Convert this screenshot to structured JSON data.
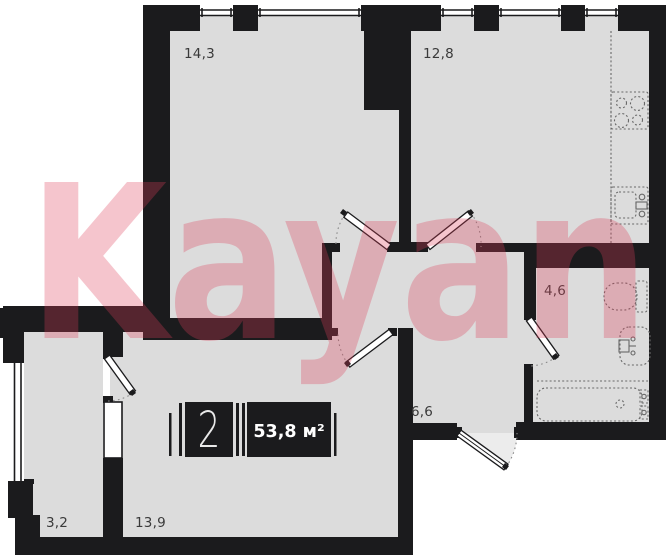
{
  "plan": {
    "badge": {
      "rooms_count": "2",
      "total_area": "53,8 м²"
    },
    "rooms": [
      {
        "name": "living-room",
        "label": "14,3"
      },
      {
        "name": "kitchen",
        "label": "12,8"
      },
      {
        "name": "bathroom",
        "label": "4,6"
      },
      {
        "name": "hallway",
        "label": "6,6"
      },
      {
        "name": "balcony",
        "label": "3,2"
      },
      {
        "name": "bedroom",
        "label": "13,9"
      }
    ],
    "fixtures": [
      "stove-icon",
      "kitchen-sink-icon",
      "toilet-icon",
      "bathroom-sink-icon",
      "bathtub-icon"
    ],
    "watermark": "Kayan",
    "colors": {
      "floor": "#dcdcdc",
      "wall": "#1b1b1d",
      "watermark": "#de4058"
    }
  }
}
